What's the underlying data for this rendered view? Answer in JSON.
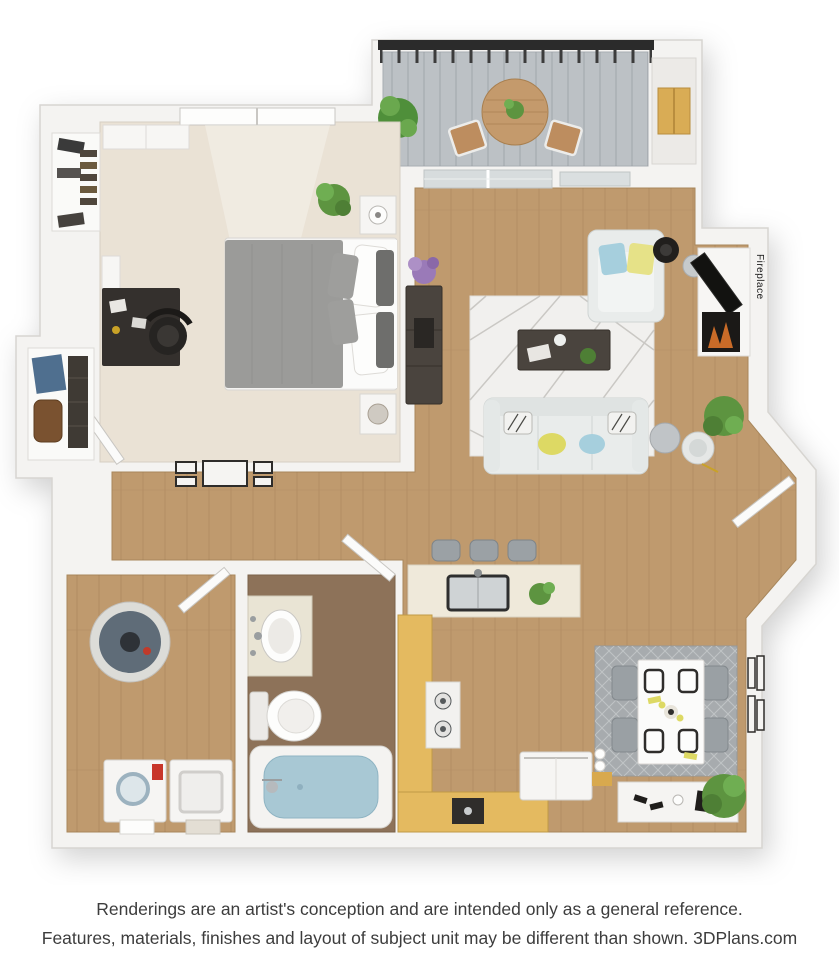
{
  "labels": {
    "fireplace": "Fireplace"
  },
  "disclaimer": {
    "line1": "Renderings are an artist's conception and are intended only as a general reference.",
    "line2": "Features, materials, finishes and layout of subject unit may be different than shown. 3DPlans.com"
  },
  "colors": {
    "wall": "#f4f3f1",
    "wall_edge": "#d7d5d1",
    "wood_floor": "#bf9a6e",
    "carpet": "#eae2d5",
    "bathroom_tile": "#8d7259",
    "oak_cabinet": "#e4ba60",
    "balcony_deck": "#bcc1c5",
    "railing": "#2b2b2b",
    "living_rug": "#f1f0ee",
    "dining_rug": "#a7abae",
    "tub_water": "#a8c8d4",
    "accent_yellow": "#ddd964",
    "accent_blue": "#a6cfdd",
    "plant_green": "#5d9440",
    "dark_wood": "#4a443e",
    "disclaimer_text": "#3d3d3d"
  }
}
